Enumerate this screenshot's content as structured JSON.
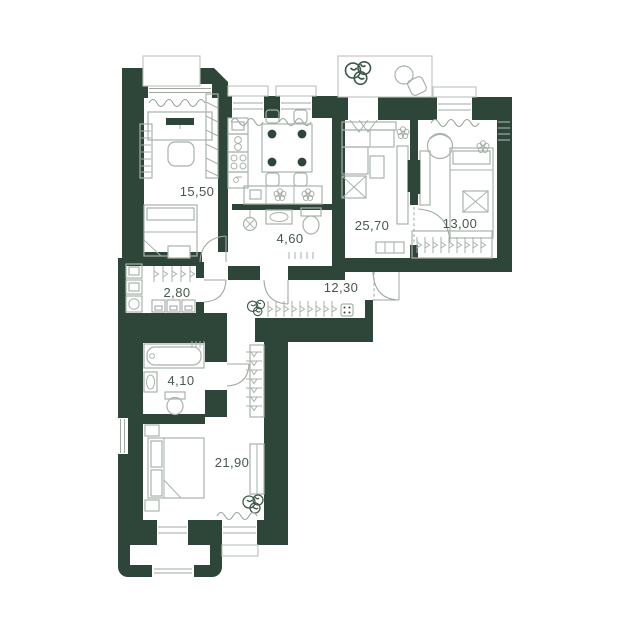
{
  "floor_plan": {
    "type": "apartment-floor-plan",
    "colors": {
      "background": "#ffffff",
      "wall": "#2d4639",
      "furniture_line": "#a8b2aa",
      "light_line": "#bcc3bc",
      "label_text": "#47584e",
      "plant": "#3f5a4b"
    },
    "rooms": [
      {
        "name": "bedroom-top-left",
        "area_label": "15,50"
      },
      {
        "name": "kitchen-living-room",
        "area_label": "25,70"
      },
      {
        "name": "bedroom-top-right",
        "area_label": "13,00"
      },
      {
        "name": "bathroom-top",
        "area_label": "4,60"
      },
      {
        "name": "dressing-laundry",
        "area_label": "2,80"
      },
      {
        "name": "hallway",
        "area_label": "12,30"
      },
      {
        "name": "bathroom-bottom",
        "area_label": "4,10"
      },
      {
        "name": "bedroom-bottom",
        "area_label": "21,90"
      }
    ]
  }
}
